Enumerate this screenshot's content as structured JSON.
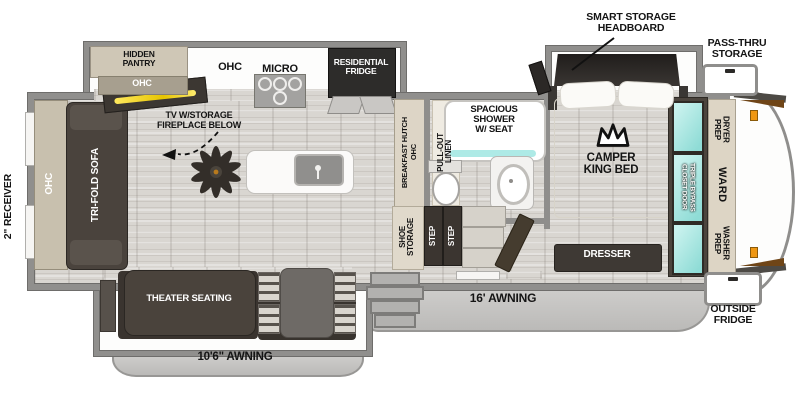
{
  "floorplan": {
    "exterior": {
      "receiver": "2\" RECEIVER",
      "awning_rear": "10'6\" AWNING",
      "awning_main": "16' AWNING",
      "pass_thru_storage": [
        "PASS-THRU",
        "STORAGE"
      ],
      "outside_fridge": [
        "OUTSIDE",
        "FRIDGE"
      ],
      "smart_storage_headboard": [
        "SMART STORAGE",
        "HEADBOARD"
      ]
    },
    "living": {
      "rear_ohc": "OHC",
      "sofa": "TRI-FOLD SOFA",
      "theater": "THEATER SEATING",
      "tv_fireplace": [
        "TV W/STORAGE",
        "FIREPLACE BELOW"
      ]
    },
    "kitchen": {
      "hidden_pantry": [
        "HIDDEN",
        "PANTRY"
      ],
      "pantry_ohc": "OHC",
      "ohc": "OHC",
      "micro": "MICRO",
      "fridge": [
        "RESIDENTIAL",
        "FRIDGE"
      ],
      "hutch": "BREAKFAST HUTCH",
      "hutch_ohc": "OHC"
    },
    "bath": {
      "linen": [
        "PULL-OUT",
        "LINEN"
      ],
      "shower": [
        "SPACIOUS",
        "SHOWER",
        "W/ SEAT"
      ]
    },
    "hall": {
      "shoe_storage": [
        "SHOE",
        "STORAGE"
      ],
      "step_upper": "STEP",
      "step_lower": "STEP"
    },
    "bedroom": {
      "bed": [
        "CAMPER",
        "KING BED"
      ],
      "dresser": "DRESSER",
      "closet": [
        "TRIPLE BYPASS",
        "CLOSET DOOR"
      ],
      "dryer_prep": [
        "DRYER",
        "PREP"
      ],
      "ward": "WARD",
      "washer_prep": [
        "WASHER",
        "PREP"
      ]
    },
    "colors": {
      "wall": "#908f8d",
      "dark_furniture": "#453f39",
      "tan_cabinet": "#cdc5b4",
      "mirror_teal": "#a9e9e5",
      "fireplace_yellow": "#f4d800",
      "awning": "#c6c5c3",
      "floor": "#d9d6d1",
      "handle_orange": "#ef9712"
    }
  }
}
